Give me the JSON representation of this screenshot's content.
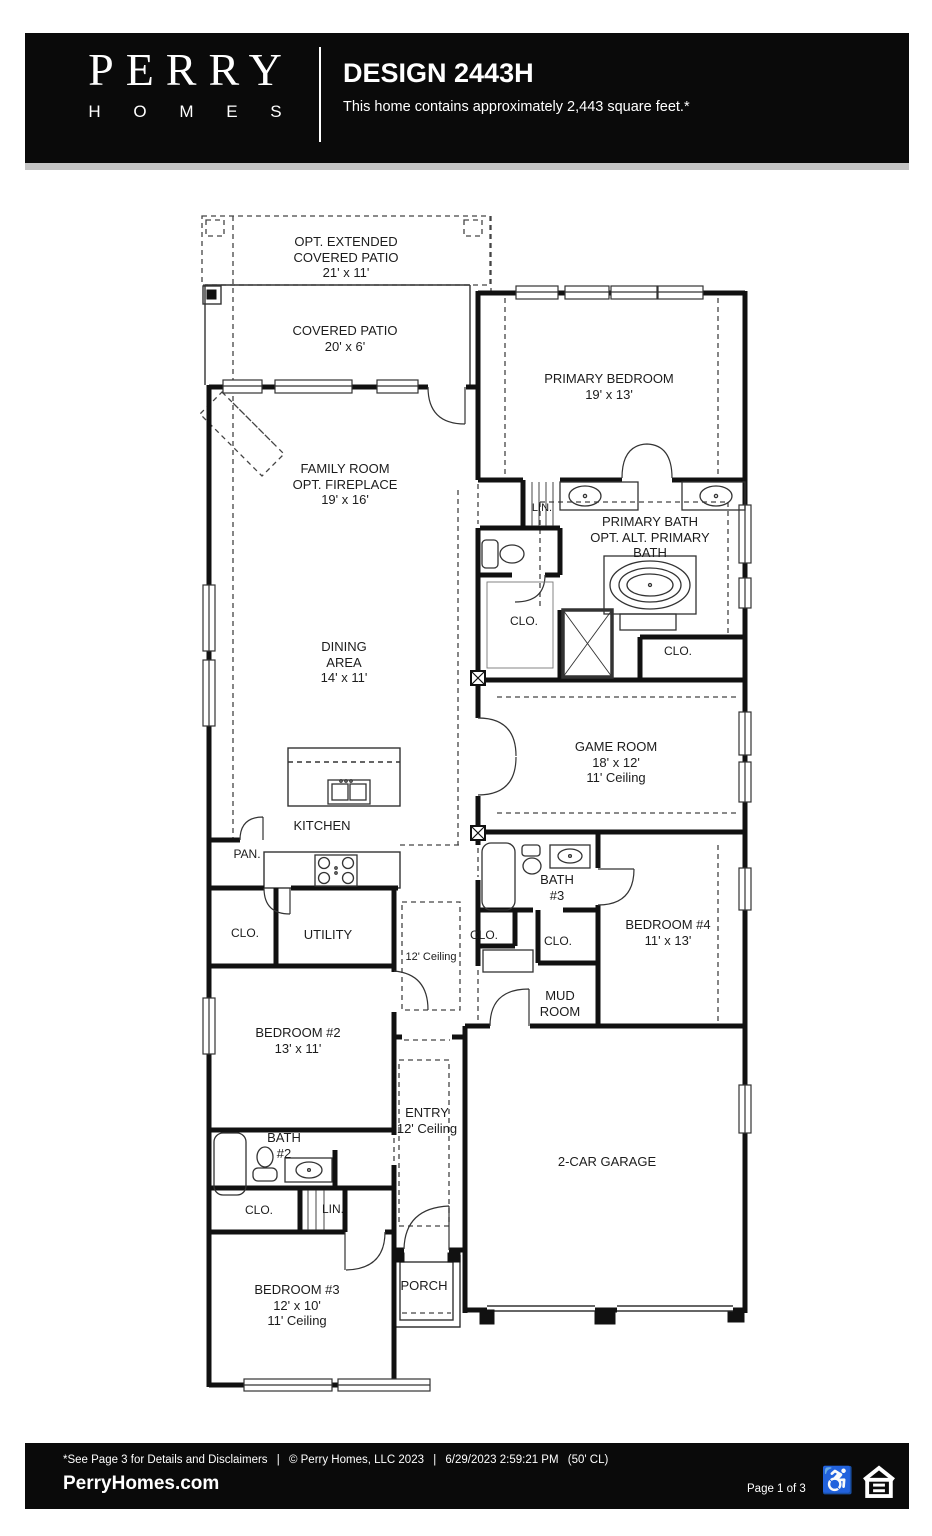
{
  "header": {
    "brand_top": "PERRY",
    "brand_bottom": "H O M E S",
    "title": "DESIGN 2443H",
    "subtitle": "This home contains approximately 2,443 square feet.*"
  },
  "plan": {
    "labels": {
      "opt_extended_patio": "OPT. EXTENDED\nCOVERED PATIO\n21' x 11'",
      "covered_patio": "COVERED PATIO\n20' x 6'",
      "family_room": "FAMILY ROOM\nOPT. FIREPLACE\n19' x 16'",
      "primary_bedroom": "PRIMARY BEDROOM\n19' x 13'",
      "lin_primary": "LIN.",
      "primary_bath": "PRIMARY BATH\nOPT. ALT. PRIMARY\nBATH",
      "dining_area": "DINING\nAREA\n14' x 11'",
      "clo_primary_left": "CLO.",
      "clo_primary_right": "CLO.",
      "game_room": "GAME ROOM\n18' x 12'\n11' Ceiling",
      "kitchen": "KITCHEN",
      "pantry": "PAN.",
      "bath_3": "BATH\n#3",
      "clo_hall_left": "CLO.",
      "clo_hall_right": "CLO.",
      "bedroom_4": "BEDROOM #4\n11' x 13'",
      "utility": "UTILITY",
      "clo_utility": "CLO.",
      "hall_ceiling": "12' Ceiling",
      "mud_room": "MUD\nROOM",
      "bedroom_2": "BEDROOM #2\n13' x 11'",
      "entry": "ENTRY\n12' Ceiling",
      "garage": "2-CAR GARAGE",
      "bath_2": "BATH\n#2",
      "clo_bedroom2": "CLO.",
      "lin_bedroom2": "LIN.",
      "bedroom_3": "BEDROOM #3\n12' x 10'\n11' Ceiling",
      "porch": "PORCH"
    }
  },
  "footer": {
    "disclaimer": "*See Page 3 for Details and Disclaimers",
    "pipe": "|",
    "copyright": "© Perry Homes, LLC 2023",
    "timestamp": "6/29/2023 2:59:21 PM",
    "lot_code": "(50' CL)",
    "website": "PerryHomes.com",
    "page_label": "Page 1 of 3",
    "icons": [
      "wheelchair-accessible-icon",
      "equal-housing-opportunity-icon"
    ]
  },
  "colors": {
    "header_bg": "#0a0a0a",
    "separator": "#c4c4c4",
    "walls": "#111111",
    "page_bg": "#ffffff"
  }
}
